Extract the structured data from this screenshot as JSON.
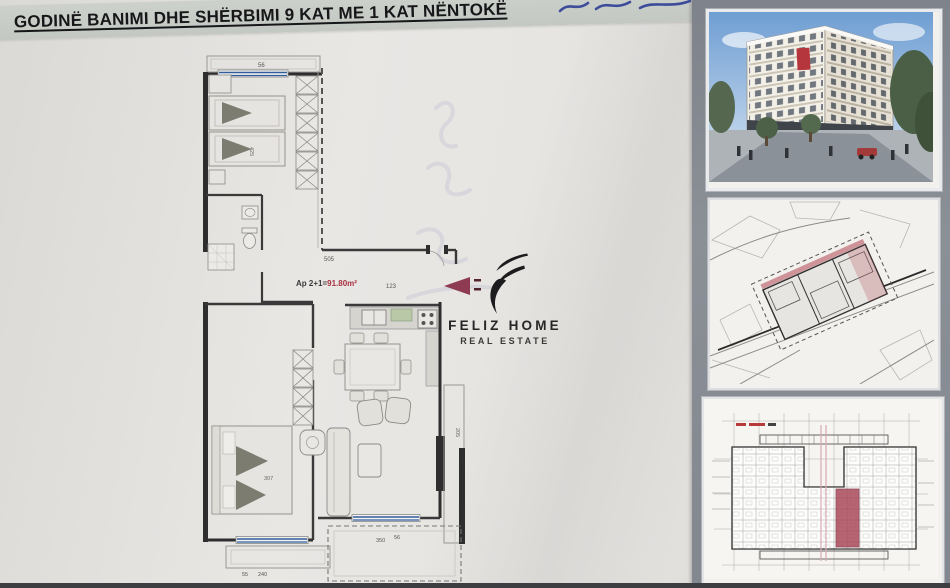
{
  "title": {
    "text": "GODINË BANIMI DHE SHËRBIMI 9 KAT ME 1 KAT NËNTOKË"
  },
  "plan": {
    "apartment_label": {
      "prefix": "Ap 2+1=",
      "area": "91.80m²"
    },
    "dims": {
      "balcony_top": "56",
      "corridor": "505",
      "corridor_small": "123",
      "bedroom1_width": "425",
      "bedroom2_width": "307",
      "balcony_left_a": "55",
      "balcony_left_b": "240",
      "balcony_right_a": "350",
      "balcony_right_b": "56",
      "balcony_side": "205"
    }
  },
  "logo": {
    "title": "FELIZ HOME",
    "subtitle": "REAL ESTATE"
  },
  "side_panel": {
    "images": [
      {
        "name": "building-render"
      },
      {
        "name": "site-plan"
      },
      {
        "name": "typical-floor-plan"
      }
    ]
  },
  "colors": {
    "accent_maroon": "#8e3a52",
    "area_red": "#a8303f",
    "window_blue": "#2f5d9e",
    "panel_gray": "#848890",
    "highlight_unit_red": "#a84355"
  }
}
